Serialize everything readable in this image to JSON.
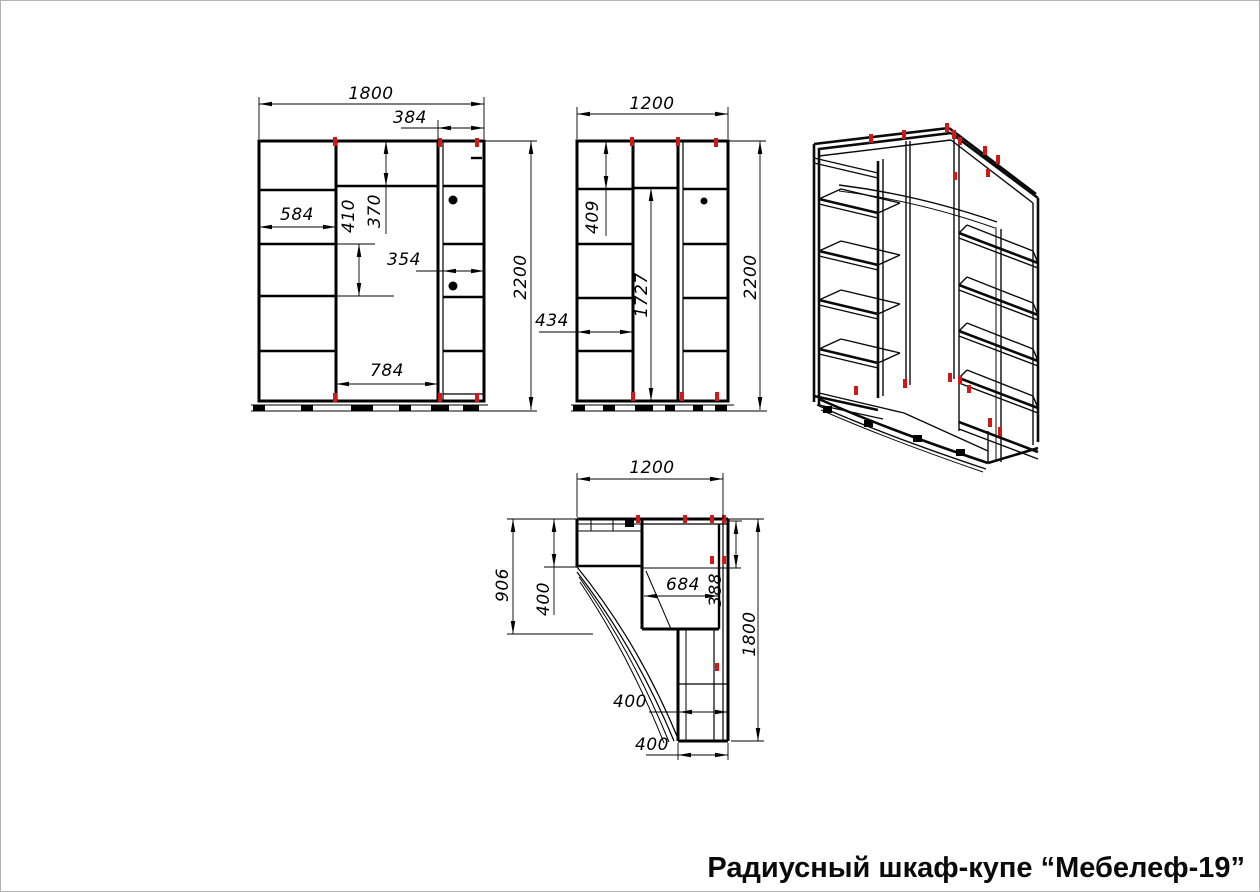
{
  "title": {
    "text": "Радиусный шкаф-купе “Мебелеф-19”"
  },
  "colors": {
    "line": "#000000",
    "accent_red": "#cc1a1a",
    "page_border": "#b3b3b3",
    "background": "#ffffff"
  },
  "views": {
    "front": {
      "dims": {
        "total_width": "1800",
        "right_section_width": "384",
        "shelf_width": "584",
        "shelf_spacing": "410",
        "top_section_height": "370",
        "right_inner_width": "354",
        "middle_width": "784",
        "total_height": "2200"
      }
    },
    "side": {
      "dims": {
        "total_width": "1200",
        "top_section_height": "409",
        "open_height": "1727",
        "total_height": "2200",
        "shelf_section_width": "434"
      }
    },
    "plan": {
      "dims": {
        "total_width": "1200",
        "left_depth": "906",
        "left_section_depth": "400",
        "corner_inner_width": "684",
        "right_section_width": "388",
        "right_depth": "1800",
        "door_opening_width": "400",
        "bottom_section_width": "400"
      }
    }
  }
}
